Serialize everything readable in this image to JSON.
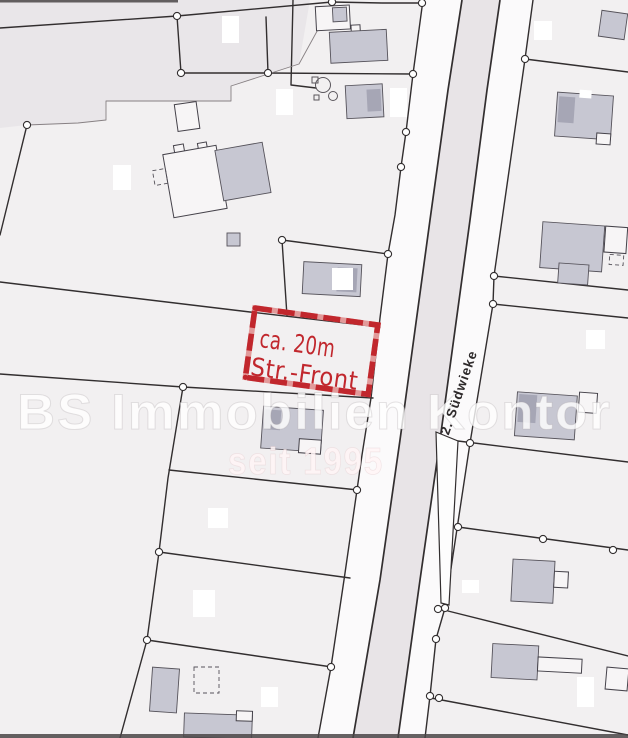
{
  "map": {
    "street_label": "2. Südwieke",
    "annotation": {
      "line1": "ca. 20m",
      "line2": "Str.-Front"
    },
    "watermark": {
      "brand": "BS Immobilien Kontor",
      "since": "seit 1995"
    }
  },
  "colors": {
    "paper": "#f2f0f1",
    "paper_dark": "#e9e6e9",
    "verge_fill": "#fbfafb",
    "road_fill": "#e8e4e7",
    "line": "#322e2f",
    "building_fill": "#c7c7d2",
    "building_dark": "#a6a6b5",
    "annotation_red": "#c1272d",
    "watermark_white": "rgba(255,255,255,0.80)",
    "watermark_pink": "rgba(255,244,246,0.85)"
  }
}
